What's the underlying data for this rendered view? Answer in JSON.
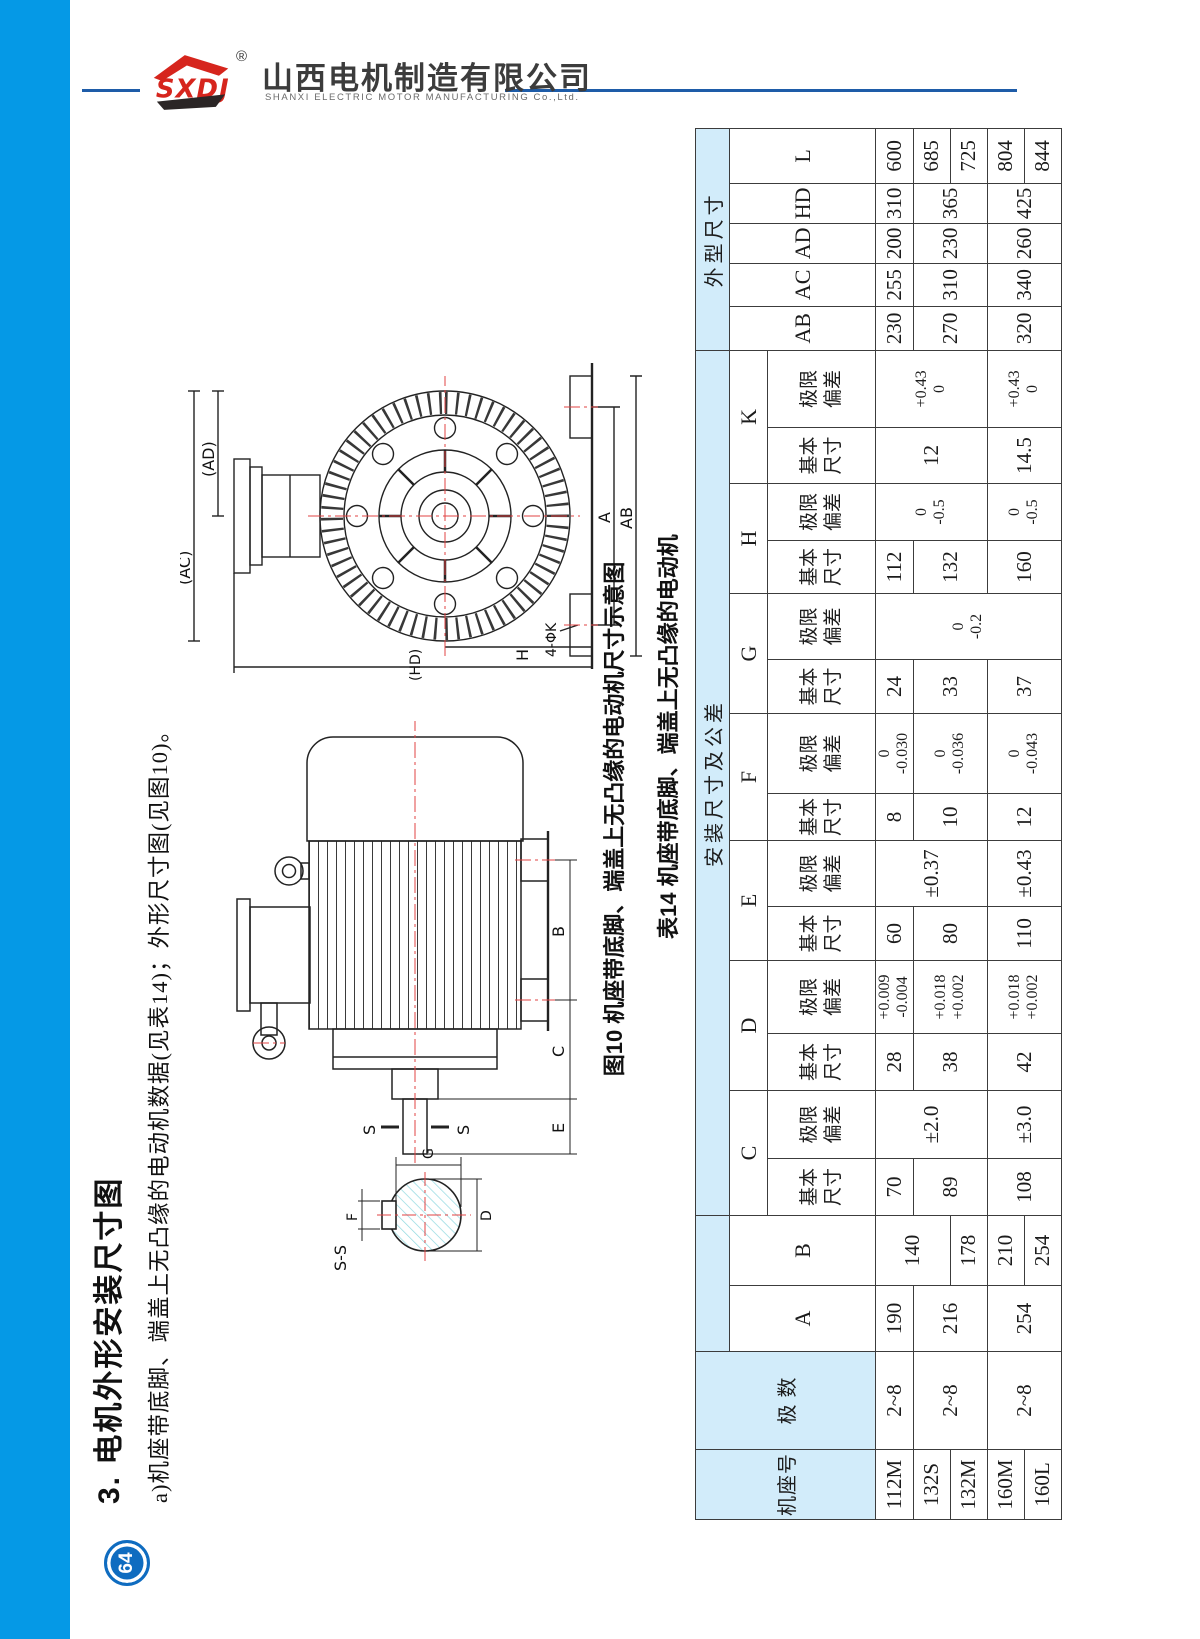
{
  "header": {
    "logo_text": "SXDJ",
    "registered": "®",
    "company_cn": "山西电机制造有限公司",
    "company_en": "SHANXI ELECTRIC MOTOR MANUFACTURING Co.,Ltd."
  },
  "page": {
    "number": "64"
  },
  "section": {
    "title": "3. 电机外形安装尺寸图",
    "subtitle": "a)机座带底脚、端盖上无凸缘的电动机数据(见表14)；外形尺寸图(见图10)。"
  },
  "figure": {
    "caption": "图10 机座带底脚、端盖上无凸缘的电动机尺寸示意图",
    "end_view_labels": {
      "ac": "(AC)",
      "ad": "(AD)",
      "a": "A",
      "ab": "AB",
      "h": "H",
      "hd": "(HD)",
      "holes": "4-ΦK"
    },
    "side_view_labels": {
      "b": "B",
      "c": "C",
      "e": "E",
      "s1": "S",
      "s2": "S"
    },
    "section_labels": {
      "title": "S-S",
      "g": "G",
      "d": "D",
      "f": "F"
    }
  },
  "table": {
    "caption": "表14 机座带底脚、端盖上无凸缘的电动机",
    "group_install": "安装尺寸及公差",
    "group_outline": "外型尺寸",
    "sub_basic": "基本尺寸",
    "sub_tol": "极限偏差",
    "cols": {
      "frame": "机座号",
      "poles": "极 数",
      "A": "A",
      "B": "B",
      "C": "C",
      "D": "D",
      "E": "E",
      "F": "F",
      "G": "G",
      "H": "H",
      "K": "K",
      "AB": "AB",
      "AC": "AC",
      "AD": "AD",
      "HD": "HD",
      "L": "L"
    },
    "rows": [
      {
        "frame": "112M",
        "poles": "2~8",
        "A": "190",
        "B": "140",
        "C_basic": "70",
        "C_tol": "±2.0",
        "D_basic": "28",
        "D_tol": "+0.009\n-0.004",
        "E_basic": "60",
        "E_tol": "±0.37",
        "F_basic": "8",
        "F_tol": "0\n-0.030",
        "G_basic": "24",
        "G_tol": "0\n-0.2",
        "H_basic": "112",
        "H_tol": "0\n-0.5",
        "K_basic": "12",
        "K_tol": "+0.43\n0",
        "AB": "230",
        "AC": "255",
        "AD": "200",
        "HD": "310",
        "L": "600"
      },
      {
        "frame": "132S",
        "poles": "2~8",
        "A": "216",
        "C_basic": "89",
        "D_basic": "38",
        "D_tol": "+0.018\n+0.002",
        "E_basic": "80",
        "F_basic": "10",
        "F_tol": "0\n-0.036",
        "G_basic": "33",
        "H_basic": "132",
        "AB": "270",
        "AC": "310",
        "AD": "230",
        "HD": "365",
        "L": "685"
      },
      {
        "frame": "132M",
        "B": "178",
        "L": "725"
      },
      {
        "frame": "160M",
        "poles": "2~8",
        "A": "254",
        "B": "210",
        "C_basic": "108",
        "C_tol": "±3.0",
        "D_basic": "42",
        "D_tol": "+0.018\n+0.002",
        "E_basic": "110",
        "E_tol": "±0.43",
        "F_basic": "12",
        "F_tol": "0\n-0.043",
        "G_basic": "37",
        "H_basic": "160",
        "H_tol": "0\n-0.5",
        "K_basic": "14.5",
        "K_tol": "+0.43\n0",
        "AB": "320",
        "AC": "340",
        "AD": "260",
        "HD": "425",
        "L": "804"
      },
      {
        "frame": "160L",
        "B": "254",
        "L": "844"
      }
    ]
  }
}
